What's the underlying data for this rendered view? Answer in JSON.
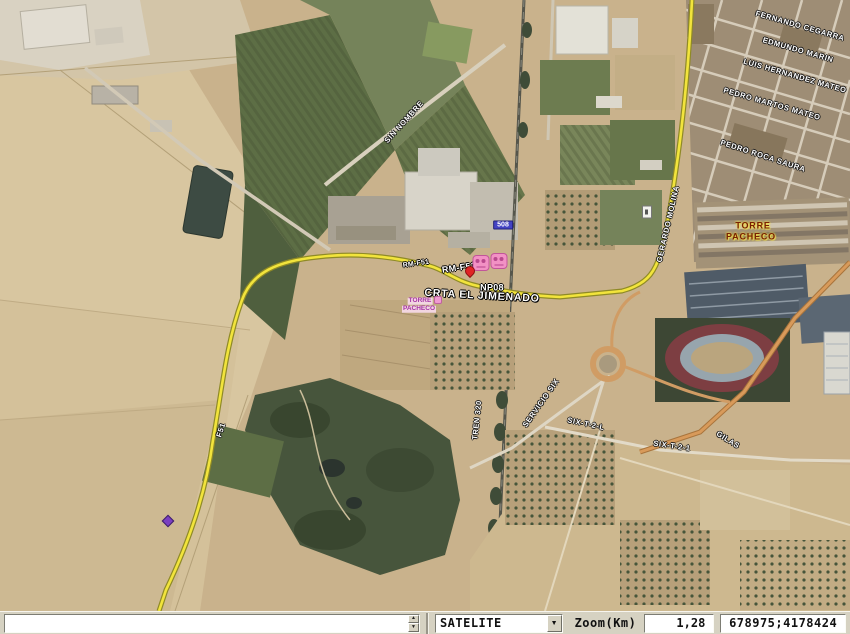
{
  "statusbar": {
    "search_value": "",
    "layer_selected": "SATELITE",
    "zoom_label": "Zoom(Km)",
    "zoom_value": "1,28",
    "coordinates": "678975;4178424"
  },
  "colors": {
    "road_yellow": "#f2e43c",
    "road_orange": "#d89a5a",
    "town_label": "#7a2000",
    "poi_purple": "#a632a6",
    "km_badge_blue": "#4343c4",
    "train_icon_pink": "#f291c4"
  },
  "map": {
    "labels": [
      {
        "id": "fernando-cegarra",
        "text": "FERNANDO CEGARRA",
        "x": 800,
        "y": 26,
        "rot": 16,
        "kind": "street"
      },
      {
        "id": "edmundo-marin",
        "text": "EDMUNDO MARIN",
        "x": 798,
        "y": 50,
        "rot": 16,
        "kind": "street"
      },
      {
        "id": "luis-hernandez-mateo",
        "text": "LUIS HERNANDEZ MATEO",
        "x": 795,
        "y": 76,
        "rot": 16,
        "kind": "street"
      },
      {
        "id": "pedro-martos-mateo",
        "text": "PEDRO MARTOS MATEO",
        "x": 772,
        "y": 104,
        "rot": 16,
        "kind": "street"
      },
      {
        "id": "pedro-roca-saura",
        "text": "PEDRO ROCA SAURA",
        "x": 763,
        "y": 156,
        "rot": 18,
        "kind": "street"
      },
      {
        "id": "torre-pacheco-town-1",
        "text": "TORRE",
        "x": 753,
        "y": 226,
        "rot": 0,
        "kind": "town"
      },
      {
        "id": "torre-pacheco-town-2",
        "text": "PACHECO",
        "x": 751,
        "y": 237,
        "rot": 0,
        "kind": "town"
      },
      {
        "id": "sin-nombre",
        "text": "SIN NOMBRE",
        "x": 404,
        "y": 122,
        "rot": -48,
        "kind": "street"
      },
      {
        "id": "rm-f51-small",
        "text": "RM-F51",
        "x": 416,
        "y": 264,
        "rot": -8,
        "kind": "road-ref-sm"
      },
      {
        "id": "rm-f51",
        "text": "RM-F51",
        "x": 459,
        "y": 268,
        "rot": -8,
        "kind": "road-ref"
      },
      {
        "id": "np08",
        "text": "NP08",
        "x": 492,
        "y": 288,
        "rot": 0,
        "kind": "road-ref"
      },
      {
        "id": "crta-el-jimenado",
        "text": "CRTA EL JIMENADO",
        "x": 482,
        "y": 296,
        "rot": 3,
        "kind": "street-lg"
      },
      {
        "id": "torre-pacheco-poi-1",
        "text": "TORRE",
        "x": 420,
        "y": 301,
        "rot": 0,
        "kind": "poi-purple"
      },
      {
        "id": "torre-pacheco-poi-2",
        "text": "PACHECO",
        "x": 419,
        "y": 309,
        "rot": 0,
        "kind": "poi-purple"
      },
      {
        "id": "gerardo-molina",
        "text": "GERARDO MOLINA",
        "x": 668,
        "y": 224,
        "rot": -77,
        "kind": "street"
      },
      {
        "id": "tren-320",
        "text": "TREN 320",
        "x": 477,
        "y": 420,
        "rot": -84,
        "kind": "street"
      },
      {
        "id": "servicio-six",
        "text": "SERVICIO SIX",
        "x": 541,
        "y": 403,
        "rot": -55,
        "kind": "street"
      },
      {
        "id": "six-t-2-l",
        "text": "SIX-T-2-L",
        "x": 586,
        "y": 424,
        "rot": 12,
        "kind": "street"
      },
      {
        "id": "six-t-2-1",
        "text": "SIX-T-2-1",
        "x": 672,
        "y": 446,
        "rot": 8,
        "kind": "street"
      },
      {
        "id": "gilas",
        "text": "GILAS",
        "x": 728,
        "y": 440,
        "rot": 32,
        "kind": "street"
      },
      {
        "id": "f51",
        "text": "F51",
        "x": 221,
        "y": 430,
        "rot": -72,
        "kind": "street"
      },
      {
        "id": "km-508",
        "text": "508",
        "x": 503,
        "y": 225,
        "rot": 0,
        "kind": "badge-blue"
      }
    ],
    "markers": [
      {
        "id": "train-icon-1",
        "kind": "train",
        "x": 481,
        "y": 263,
        "interactable": true
      },
      {
        "id": "train-icon-2",
        "kind": "train",
        "x": 499,
        "y": 261,
        "interactable": true
      },
      {
        "id": "red-marker-icon",
        "kind": "red-pin",
        "x": 470,
        "y": 271,
        "interactable": true
      },
      {
        "id": "road-sign-icon",
        "kind": "white-sign",
        "x": 647,
        "y": 212,
        "interactable": false
      },
      {
        "id": "purple-marker-icon",
        "kind": "purple-pin",
        "x": 168,
        "y": 521,
        "interactable": true
      },
      {
        "id": "pink-poi-icon",
        "kind": "pink-dot",
        "x": 438,
        "y": 300,
        "interactable": true
      }
    ]
  }
}
